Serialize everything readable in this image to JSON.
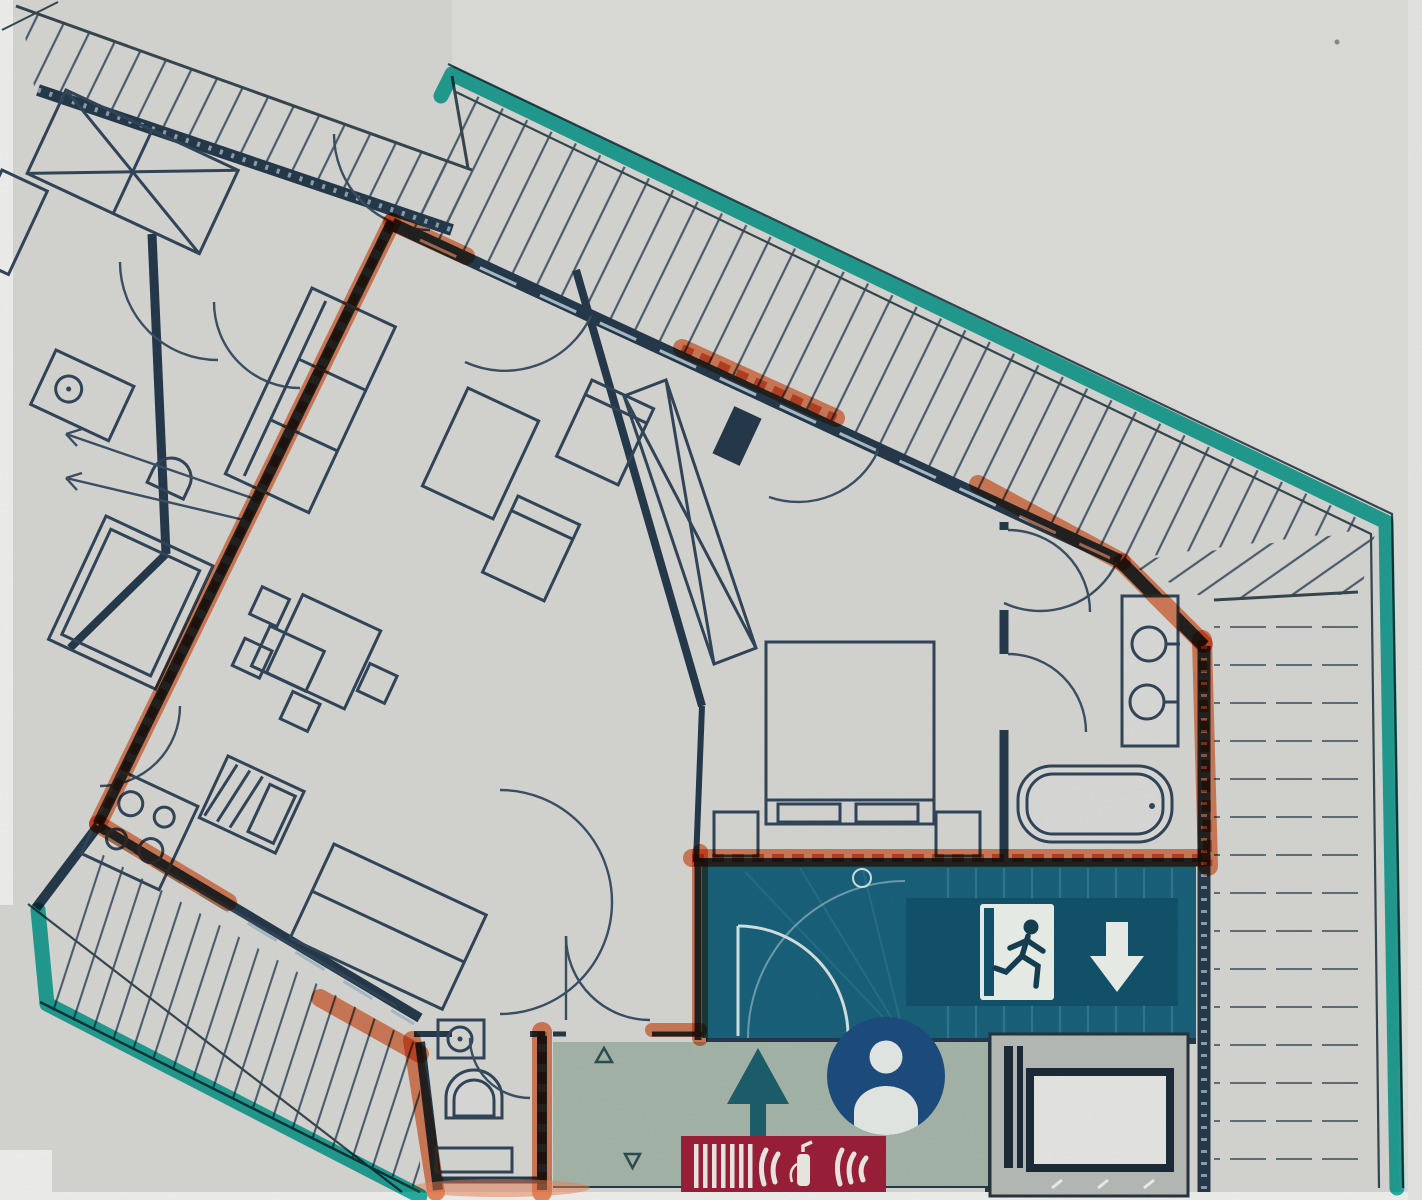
{
  "document": {
    "kind": "scanned architectural floor plan, no printed text visible"
  },
  "colors": {
    "paper": "#d8d7d4",
    "paper_light": "#dfdedb",
    "white": "#f2f2ef",
    "line": "#2e4156",
    "wall_dark": "#253a4b",
    "teal_highlight": "#10b1a6",
    "orange_highlight": "#ef7f52",
    "orange_deep": "#d85f2f",
    "stairwell_teal": "#1a617b",
    "sign_teal": "#11526a",
    "corridor_sage": "#a7b6aa",
    "person_blue": "#1d4d7f",
    "fire_sign_red": "#9c2038",
    "elevator_gray": "#b9bcb8",
    "hatch_line": "#4c5e6e",
    "glyph_white": "#edf1ec",
    "arrow_teal": "#1d5f6b"
  },
  "highlights": {
    "teal_boundary": "outer building / roof edge traced with teal highlighter",
    "orange_walls": "apartment separation walls traced with orange highlighter"
  },
  "icons": [
    {
      "name": "emergency-exit-sign",
      "glyph": "running-man-through-door"
    },
    {
      "name": "stairs-down-arrow-icon",
      "glyph": "↓"
    },
    {
      "name": "entry-up-arrow-icon",
      "glyph": "↑"
    },
    {
      "name": "person-marker-icon",
      "glyph": "bust-in-circle"
    },
    {
      "name": "fire-equipment-sign",
      "glyph": "extinguisher-with-flames-and-bars"
    },
    {
      "name": "slope-triangle-up-icon",
      "glyph": "△"
    },
    {
      "name": "slope-triangle-down-icon",
      "glyph": "▽"
    }
  ]
}
